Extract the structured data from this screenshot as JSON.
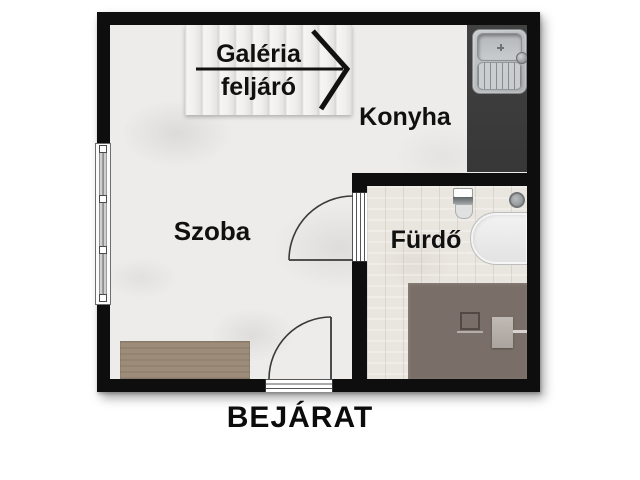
{
  "title": "Apartment floor plan",
  "labels": {
    "gallery_line1": "Galéria",
    "gallery_line2": "feljáró",
    "kitchen": "Konyha",
    "room": "Szoba",
    "bathroom": "Fürdő",
    "entrance": "BEJÁRAT"
  },
  "fixtures": [
    "staircase",
    "stair-direction-arrow",
    "kitchen-counter",
    "kitchen-sink",
    "window",
    "bathroom-door",
    "entrance-door",
    "toilet",
    "floor-drain",
    "bathtub",
    "shower-platform",
    "washing-machine",
    "bed"
  ],
  "colors": {
    "wall": "#0e0e0e",
    "concrete_floor": "#edecea",
    "wood_floor": "#e9e5df",
    "kitchen_counter": "#3b3b3b",
    "platform": "#7a6f68",
    "bed": "#9c8c79",
    "sink_metal": "#b5b8ba",
    "bathtub": "#efefef",
    "text": "#101010"
  }
}
